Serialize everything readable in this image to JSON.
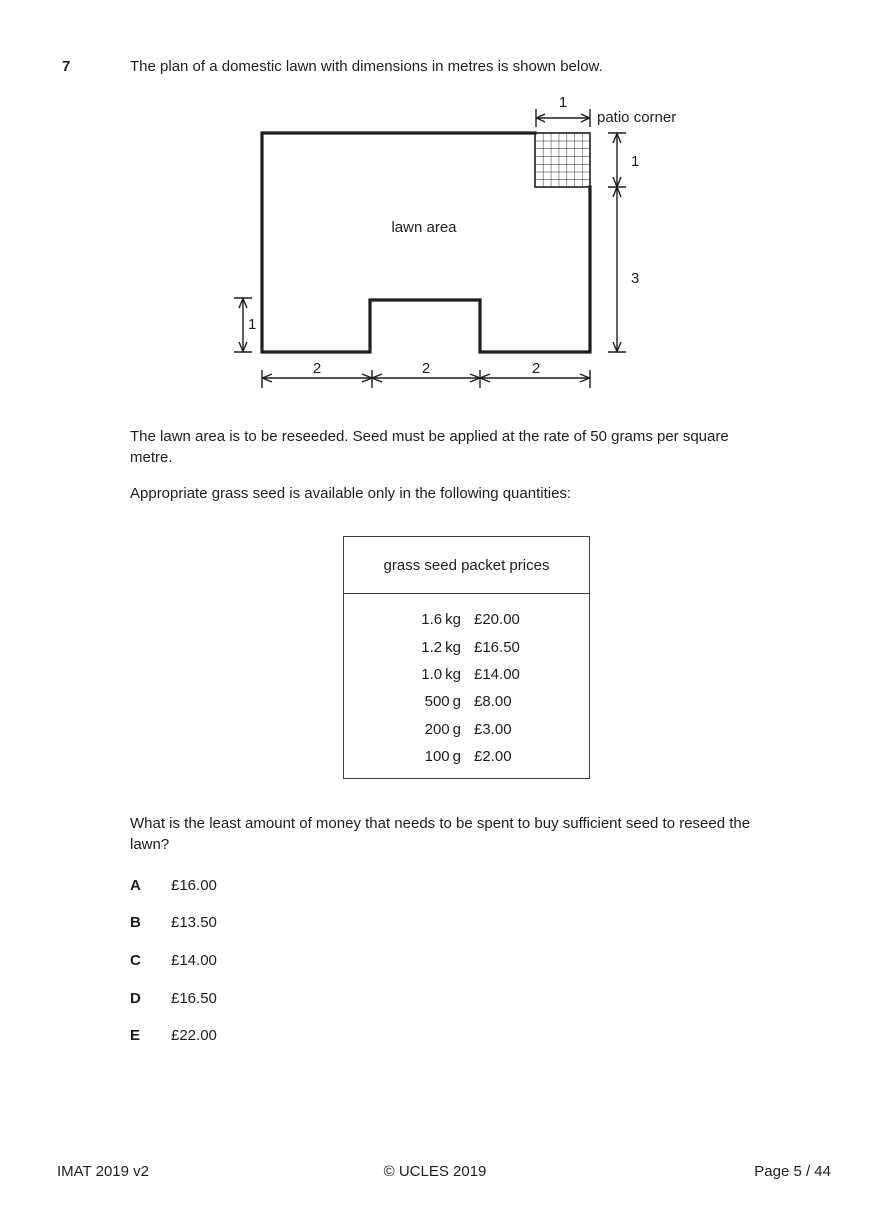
{
  "question": {
    "number": "7",
    "intro": "The plan of a domestic lawn with dimensions in metres is shown below."
  },
  "diagram": {
    "lawn_label": "lawn area",
    "patio_label": "patio corner",
    "dims": {
      "top": "1",
      "right_upper": "1",
      "right_lower": "3",
      "left": "1",
      "bottom_1": "2",
      "bottom_2": "2",
      "bottom_3": "2"
    }
  },
  "paragraphs": {
    "reseed_line1": "The lawn area is to be reseeded. Seed must be applied at the rate of 50 grams per square",
    "reseed_line2": "metre.",
    "available": "Appropriate grass seed is available only in the following quantities:",
    "question_line1": "What is the least amount of money that needs to be spent to buy sufficient seed to reseed the",
    "question_line2": "lawn?"
  },
  "price_table": {
    "title": "grass seed packet prices",
    "rows": [
      {
        "qty": "1.6 kg",
        "price": "£20.00"
      },
      {
        "qty": "1.2 kg",
        "price": "£16.50"
      },
      {
        "qty": "1.0 kg",
        "price": "£14.00"
      },
      {
        "qty": "500 g",
        "price": "£8.00"
      },
      {
        "qty": "200 g",
        "price": "£3.00"
      },
      {
        "qty": "100 g",
        "price": "£2.00"
      }
    ]
  },
  "options": [
    {
      "letter": "A",
      "value": "£16.00"
    },
    {
      "letter": "B",
      "value": "£13.50"
    },
    {
      "letter": "C",
      "value": "£14.00"
    },
    {
      "letter": "D",
      "value": "£16.50"
    },
    {
      "letter": "E",
      "value": "£22.00"
    }
  ],
  "footer": {
    "left": "IMAT 2019 v2",
    "center": "© UCLES 2019",
    "right": "Page 5 / 44"
  },
  "colors": {
    "ink": "#1e1e1e",
    "background": "#ffffff"
  }
}
